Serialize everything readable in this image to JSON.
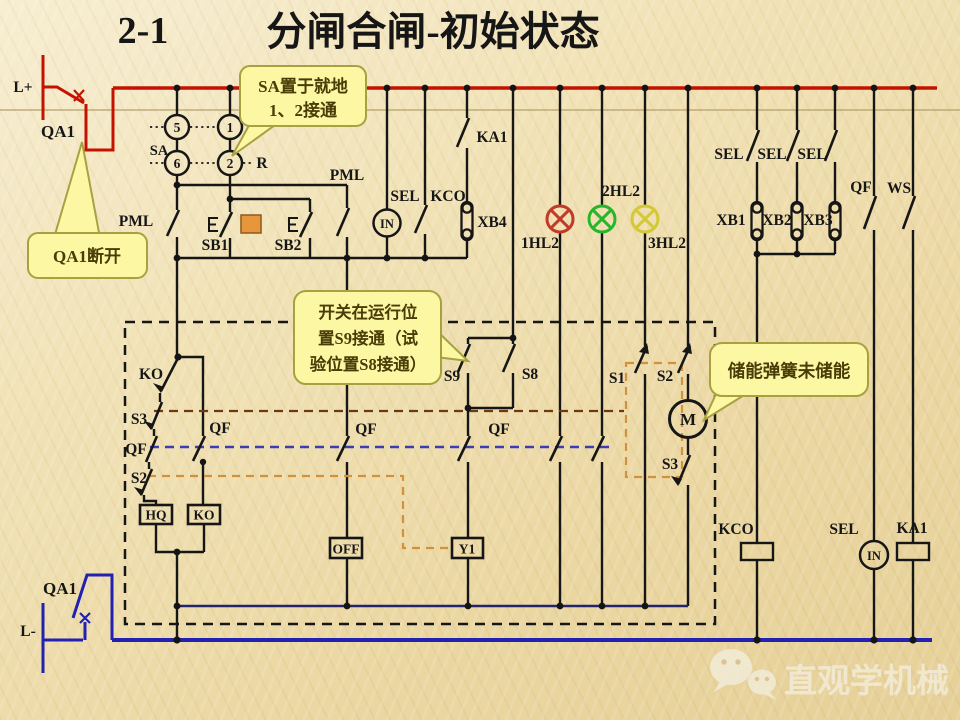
{
  "title": {
    "number": "2-1",
    "main": "分闸合闸-初始状态"
  },
  "rails": {
    "positive": "L+",
    "negative": "L-"
  },
  "selector": {
    "name": "SA",
    "t5": "5",
    "t1": "1",
    "t6": "6",
    "t2": "2",
    "r": "R"
  },
  "labels": {
    "qa1_top": "QA1",
    "qa1_bottom": "QA1",
    "pml_left": "PML",
    "pml_right": "PML",
    "sb1": "SB1",
    "sb2": "SB2",
    "sel_mid": "SEL",
    "kco_mid": "KCO",
    "xb4": "XB4",
    "ka1_top": "KA1",
    "hl1": "1HL2",
    "hl2": "2HL2",
    "hl3": "3HL2",
    "sel_a": "SEL",
    "sel_b": "SEL",
    "sel_c": "SEL",
    "xb1": "XB1",
    "xb2": "XB2",
    "xb3": "XB3",
    "qf_top": "QF",
    "ws": "WS",
    "ko_contact": "KO",
    "s3_left": "S3",
    "qf_left": "QF",
    "s2_left": "S2",
    "qf_branch": "QF",
    "qf_off": "QF",
    "qf_y1": "QF",
    "s9": "S9",
    "s8": "S8",
    "s1": "S1",
    "s2_mid": "S2",
    "s3_right": "S3",
    "kco_coil": "KCO",
    "sel_bottom": "SEL",
    "ka1_coil": "KA1"
  },
  "coils": {
    "hq": "HQ",
    "ko": "KO",
    "off": "OFF",
    "y1": "Y1"
  },
  "devices": {
    "in_top": "IN",
    "in_bottom": "IN",
    "motor": "M"
  },
  "callouts": {
    "sa": {
      "line1": "SA置于就地",
      "line2": "1、2接通"
    },
    "qa1": {
      "line1": "QA1断开"
    },
    "position": {
      "line1": "开关在运行位",
      "line2": "置S9接通（试",
      "line3": "验位置S8接通）"
    },
    "spring": {
      "line1": "储能弹簧未储能"
    }
  },
  "watermark": {
    "text": "直观学机械"
  },
  "colors": {
    "bus_positive": "#c41200",
    "bus_negative": "#2121b2",
    "wire": "#161616",
    "lamp_red": "#c0392b",
    "lamp_green": "#27b52a",
    "lamp_yellow": "#d2c935",
    "callout_bg": "#fbf7a3",
    "callout_border": "#a8a141",
    "callout_text": "#4a3c06",
    "highlight": "#e8963c",
    "linkage_brown": "#6b3a10",
    "linkage_blue": "#3c3cb4",
    "linkage_orange": "#d2913c",
    "inner_rail": "#23236e"
  }
}
